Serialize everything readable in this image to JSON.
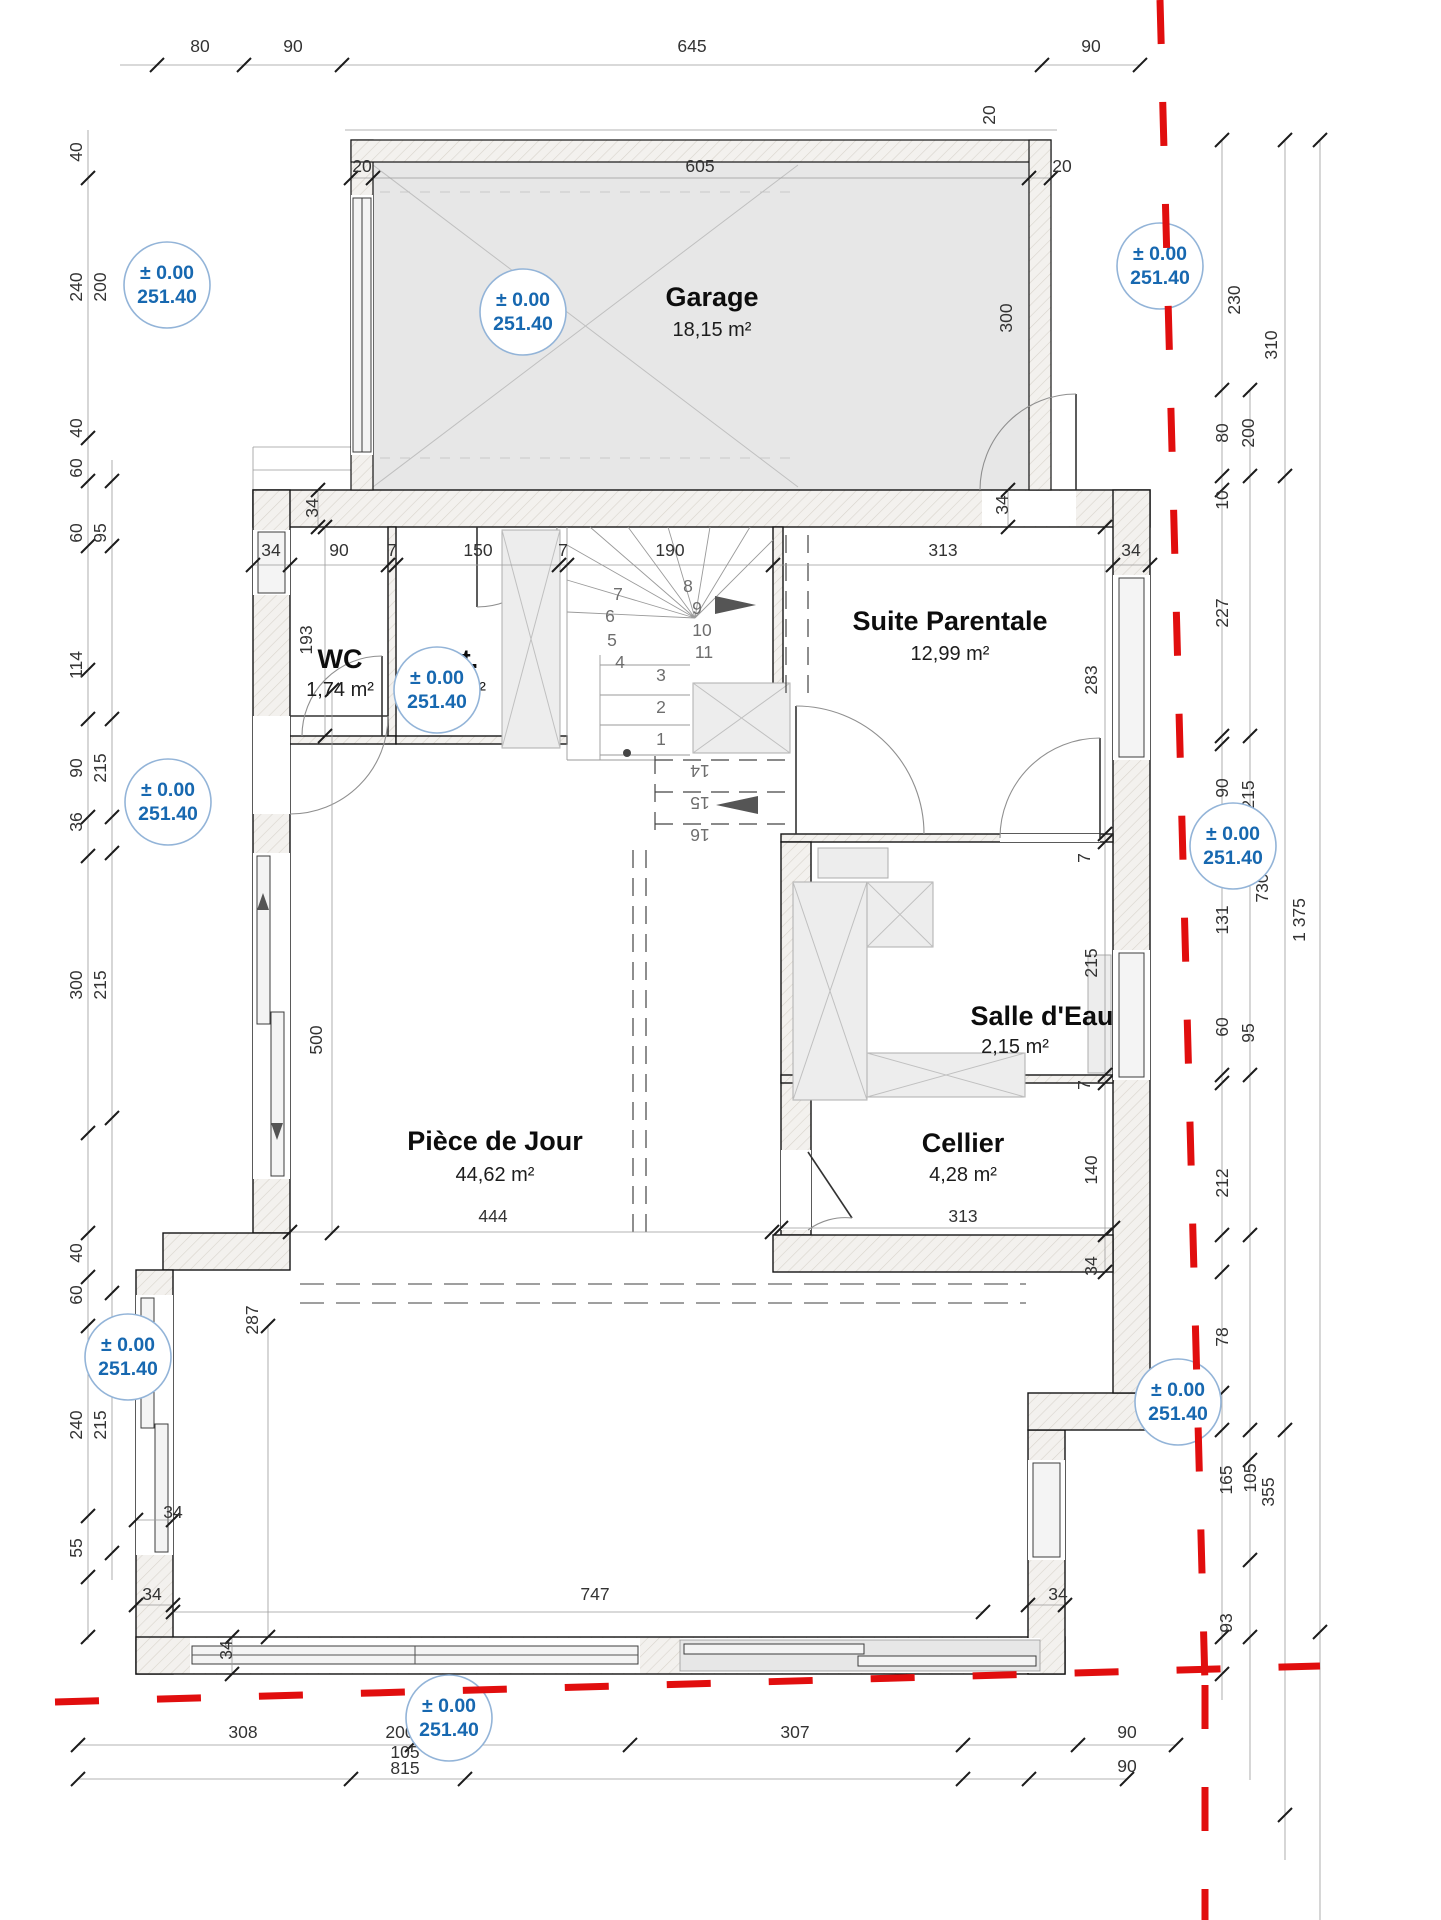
{
  "drawing": {
    "type": "floor-plan",
    "level_note": "ground floor"
  },
  "elevation": {
    "line1": "± 0.00",
    "line2": "251.40"
  },
  "elevation_markers": [
    {
      "x": 167,
      "y": 285
    },
    {
      "x": 523,
      "y": 312
    },
    {
      "x": 1160,
      "y": 266
    },
    {
      "x": 168,
      "y": 802
    },
    {
      "x": 437,
      "y": 690
    },
    {
      "x": 1233,
      "y": 846
    },
    {
      "x": 128,
      "y": 1357
    },
    {
      "x": 1178,
      "y": 1402
    },
    {
      "x": 449,
      "y": 1718
    }
  ],
  "colors": {
    "boundary_red": "#e10e0e",
    "elevation_blue": "#1768b0",
    "wall_edge": "#141414"
  },
  "rooms": {
    "garage": {
      "name": "Garage",
      "area": "18,15 m²"
    },
    "wc": {
      "name": "WC",
      "area": "1,74 m²"
    },
    "dgt": {
      "name": "Dgt.",
      "area": "2,90 m²"
    },
    "suite": {
      "name": "Suite Parentale",
      "area": "12,99 m²"
    },
    "salle_deau": {
      "name": "Salle d'Eau",
      "area": "2,15 m²"
    },
    "cellier": {
      "name": "Cellier",
      "area": "4,28 m²"
    },
    "piece_de_jour": {
      "name": "Pièce de Jour",
      "area": "44,62 m²"
    }
  },
  "dimensions": [
    {
      "v": "80",
      "x": 200,
      "y": 52
    },
    {
      "v": "90",
      "x": 293,
      "y": 52
    },
    {
      "v": "645",
      "x": 692,
      "y": 52
    },
    {
      "v": "90",
      "x": 1091,
      "y": 52
    },
    {
      "v": "20",
      "x": 362,
      "y": 172
    },
    {
      "v": "605",
      "x": 700,
      "y": 172
    },
    {
      "v": "20",
      "x": 995,
      "y": 115,
      "r": 1
    },
    {
      "v": "20",
      "x": 1062,
      "y": 172
    },
    {
      "v": "300",
      "x": 1012,
      "y": 318,
      "r": 1
    },
    {
      "v": "230",
      "x": 1240,
      "y": 300,
      "r": 1
    },
    {
      "v": "310",
      "x": 1277,
      "y": 345,
      "r": 1
    },
    {
      "v": "80",
      "x": 1228,
      "y": 433,
      "r": 1
    },
    {
      "v": "200",
      "x": 1254,
      "y": 433,
      "r": 1
    },
    {
      "v": "10",
      "x": 1228,
      "y": 500,
      "r": 1
    },
    {
      "v": "34",
      "x": 271,
      "y": 556
    },
    {
      "v": "90",
      "x": 339,
      "y": 556
    },
    {
      "v": "7",
      "x": 392,
      "y": 556
    },
    {
      "v": "150",
      "x": 478,
      "y": 556
    },
    {
      "v": "7",
      "x": 563,
      "y": 556
    },
    {
      "v": "190",
      "x": 670,
      "y": 556
    },
    {
      "v": "313",
      "x": 943,
      "y": 556
    },
    {
      "v": "34",
      "x": 1131,
      "y": 556
    },
    {
      "v": "34",
      "x": 318,
      "y": 508,
      "r": 1
    },
    {
      "v": "34",
      "x": 1008,
      "y": 505,
      "r": 1
    },
    {
      "v": "227",
      "x": 1228,
      "y": 613,
      "r": 1
    },
    {
      "v": "283",
      "x": 1097,
      "y": 680,
      "r": 1
    },
    {
      "v": "193",
      "x": 312,
      "y": 640,
      "r": 1
    },
    {
      "v": "90",
      "x": 1228,
      "y": 788,
      "r": 1
    },
    {
      "v": "215",
      "x": 1254,
      "y": 795,
      "r": 1
    },
    {
      "v": "730",
      "x": 1268,
      "y": 888,
      "r": 1
    },
    {
      "v": "1 375",
      "x": 1305,
      "y": 920,
      "r": 1
    },
    {
      "v": "131",
      "x": 1228,
      "y": 920,
      "r": 1
    },
    {
      "v": "7",
      "x": 1090,
      "y": 858,
      "r": 1
    },
    {
      "v": "215",
      "x": 1097,
      "y": 963,
      "r": 1
    },
    {
      "v": "60",
      "x": 1228,
      "y": 1027,
      "r": 1
    },
    {
      "v": "95",
      "x": 1254,
      "y": 1033,
      "r": 1
    },
    {
      "v": "7",
      "x": 1090,
      "y": 1085,
      "r": 1
    },
    {
      "v": "140",
      "x": 1097,
      "y": 1170,
      "r": 1
    },
    {
      "v": "212",
      "x": 1228,
      "y": 1183,
      "r": 1
    },
    {
      "v": "34",
      "x": 1097,
      "y": 1266,
      "r": 1
    },
    {
      "v": "313",
      "x": 963,
      "y": 1222
    },
    {
      "v": "444",
      "x": 493,
      "y": 1222
    },
    {
      "v": "500",
      "x": 322,
      "y": 1040,
      "r": 1
    },
    {
      "v": "287",
      "x": 258,
      "y": 1320,
      "r": 1
    },
    {
      "v": "78",
      "x": 1228,
      "y": 1337,
      "r": 1
    },
    {
      "v": "165",
      "x": 1232,
      "y": 1480,
      "r": 1
    },
    {
      "v": "105",
      "x": 1256,
      "y": 1478,
      "r": 1
    },
    {
      "v": "355",
      "x": 1274,
      "y": 1492,
      "r": 1
    },
    {
      "v": "93",
      "x": 1232,
      "y": 1623,
      "r": 1
    },
    {
      "v": "34",
      "x": 173,
      "y": 1518
    },
    {
      "v": "34",
      "x": 152,
      "y": 1600
    },
    {
      "v": "34",
      "x": 232,
      "y": 1650,
      "r": 1
    },
    {
      "v": "34",
      "x": 1058,
      "y": 1600
    },
    {
      "v": "747",
      "x": 595,
      "y": 1600
    },
    {
      "v": "308",
      "x": 243,
      "y": 1738
    },
    {
      "v": "200",
      "x": 400,
      "y": 1738
    },
    {
      "v": "307",
      "x": 795,
      "y": 1738
    },
    {
      "v": "90",
      "x": 1127,
      "y": 1738
    },
    {
      "v": "105",
      "x": 405,
      "y": 1758
    },
    {
      "v": "815",
      "x": 405,
      "y": 1774
    },
    {
      "v": "90",
      "x": 1127,
      "y": 1772
    },
    {
      "v": "40",
      "x": 82,
      "y": 152,
      "r": 1
    },
    {
      "v": "240",
      "x": 82,
      "y": 287,
      "r": 1
    },
    {
      "v": "200",
      "x": 106,
      "y": 287,
      "r": 1
    },
    {
      "v": "40",
      "x": 82,
      "y": 428,
      "r": 1
    },
    {
      "v": "60",
      "x": 82,
      "y": 468,
      "r": 1
    },
    {
      "v": "60",
      "x": 82,
      "y": 533,
      "r": 1
    },
    {
      "v": "95",
      "x": 106,
      "y": 533,
      "r": 1
    },
    {
      "v": "114",
      "x": 82,
      "y": 665,
      "r": 1
    },
    {
      "v": "90",
      "x": 82,
      "y": 768,
      "r": 1
    },
    {
      "v": "215",
      "x": 106,
      "y": 768,
      "r": 1
    },
    {
      "v": "36",
      "x": 82,
      "y": 822,
      "r": 1
    },
    {
      "v": "300",
      "x": 82,
      "y": 985,
      "r": 1
    },
    {
      "v": "215",
      "x": 106,
      "y": 985,
      "r": 1
    },
    {
      "v": "40",
      "x": 82,
      "y": 1253,
      "r": 1
    },
    {
      "v": "60",
      "x": 82,
      "y": 1295,
      "r": 1
    },
    {
      "v": "240",
      "x": 82,
      "y": 1425,
      "r": 1
    },
    {
      "v": "215",
      "x": 106,
      "y": 1425,
      "r": 1
    },
    {
      "v": "55",
      "x": 82,
      "y": 1548,
      "r": 1
    },
    {
      "v": "1",
      "x": 661,
      "y": 745,
      "s": 12
    },
    {
      "v": "2",
      "x": 661,
      "y": 713,
      "s": 12
    },
    {
      "v": "3",
      "x": 661,
      "y": 681,
      "s": 12
    },
    {
      "v": "4",
      "x": 620,
      "y": 668,
      "s": 11
    },
    {
      "v": "5",
      "x": 612,
      "y": 646,
      "s": 11
    },
    {
      "v": "6",
      "x": 610,
      "y": 622,
      "s": 11
    },
    {
      "v": "7",
      "x": 618,
      "y": 600,
      "s": 11
    },
    {
      "v": "8",
      "x": 688,
      "y": 592,
      "s": 11
    },
    {
      "v": "9",
      "x": 697,
      "y": 614,
      "s": 11
    },
    {
      "v": "10",
      "x": 702,
      "y": 636,
      "s": 11
    },
    {
      "v": "11",
      "x": 704,
      "y": 658,
      "s": 11
    },
    {
      "v": "14",
      "x": 700,
      "y": 765,
      "s": 12,
      "r": 2
    },
    {
      "v": "15",
      "x": 700,
      "y": 797,
      "s": 12,
      "r": 2
    },
    {
      "v": "16",
      "x": 700,
      "y": 829,
      "s": 12,
      "r": 2
    }
  ]
}
